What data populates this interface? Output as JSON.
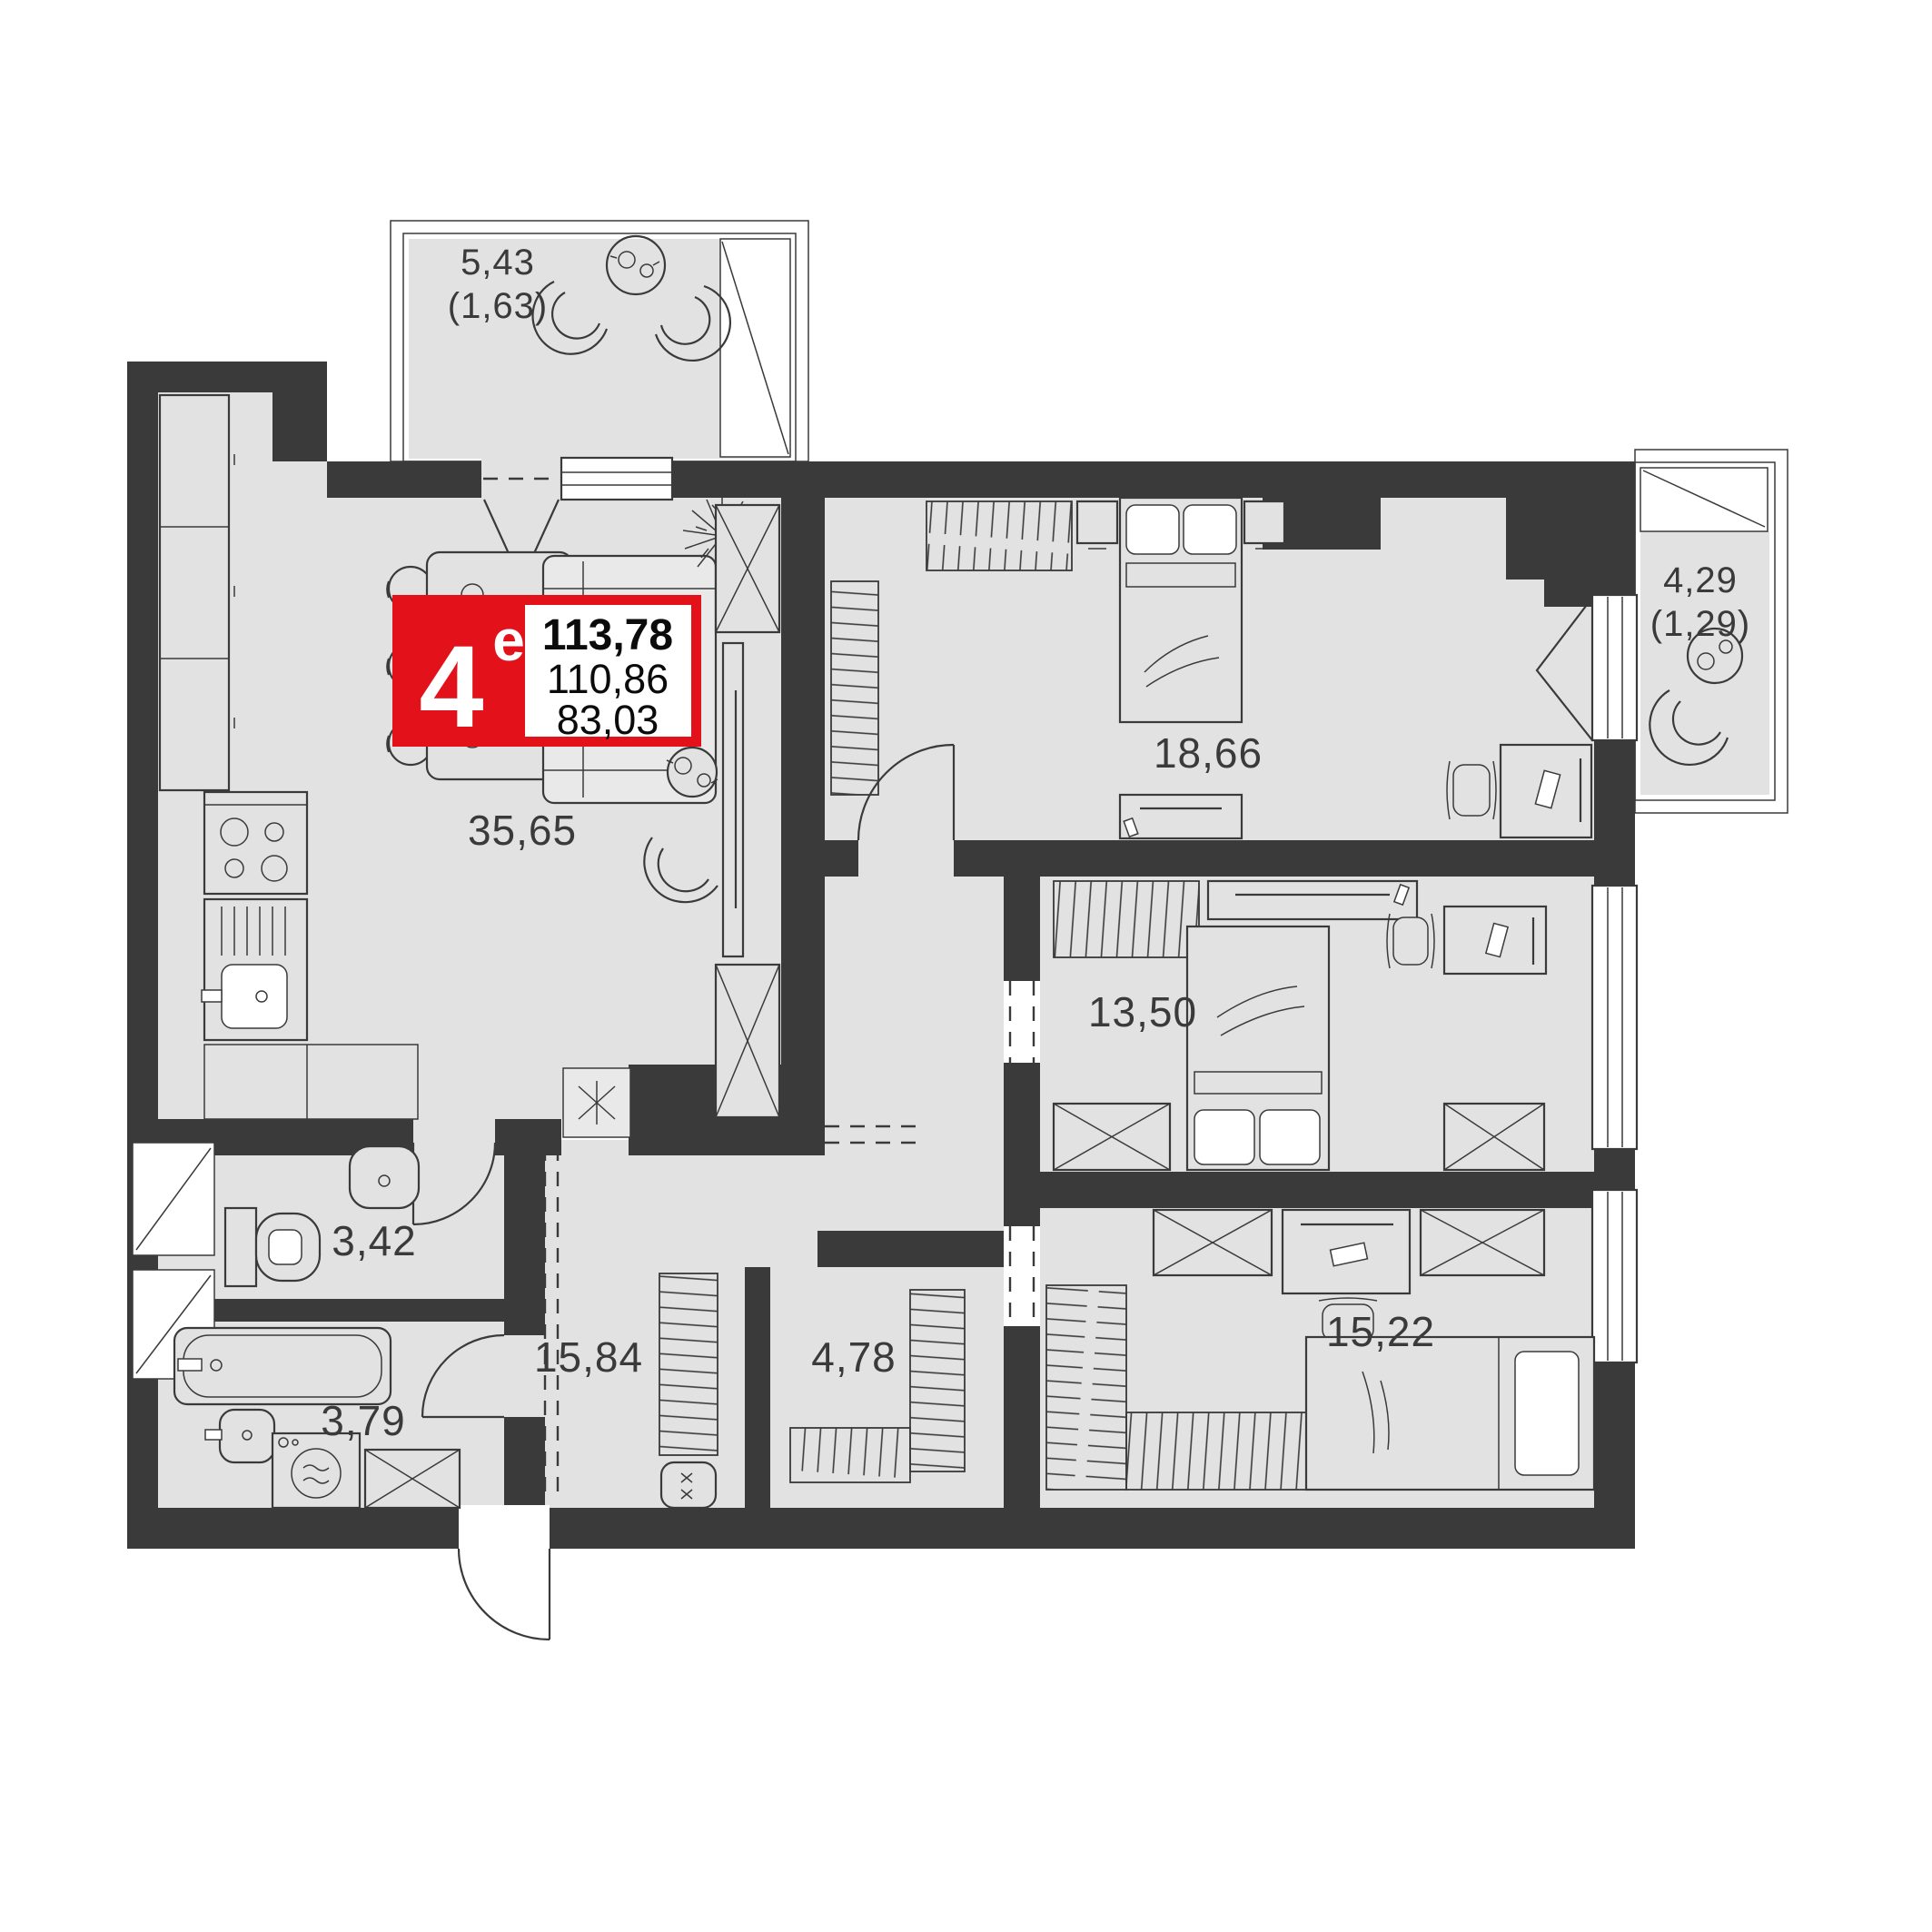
{
  "plan": {
    "unit_badge": {
      "rooms_count": "4",
      "type_letter": "е",
      "area_total": "113,78",
      "area_secondary": "110,86",
      "area_living": "83,03"
    },
    "rooms": {
      "living_kitchen": "35,65",
      "bedroom_master": "18,66",
      "bedroom_middle": "13,50",
      "bedroom_lower": "15,22",
      "hallway": "15,84",
      "wardrobe_room": "4,78",
      "wc": "3,42",
      "bathroom": "3,79"
    },
    "balconies": {
      "top": {
        "area": "5,43",
        "reduced": "(1,63)"
      },
      "right": {
        "area": "4,29",
        "reduced": "(1,29)"
      }
    },
    "colors": {
      "wall": "#3a3a3a",
      "floor": "#e2e2e2",
      "accent": "#e3121a",
      "line": "#3a3a3a",
      "paper": "#ffffff"
    }
  }
}
